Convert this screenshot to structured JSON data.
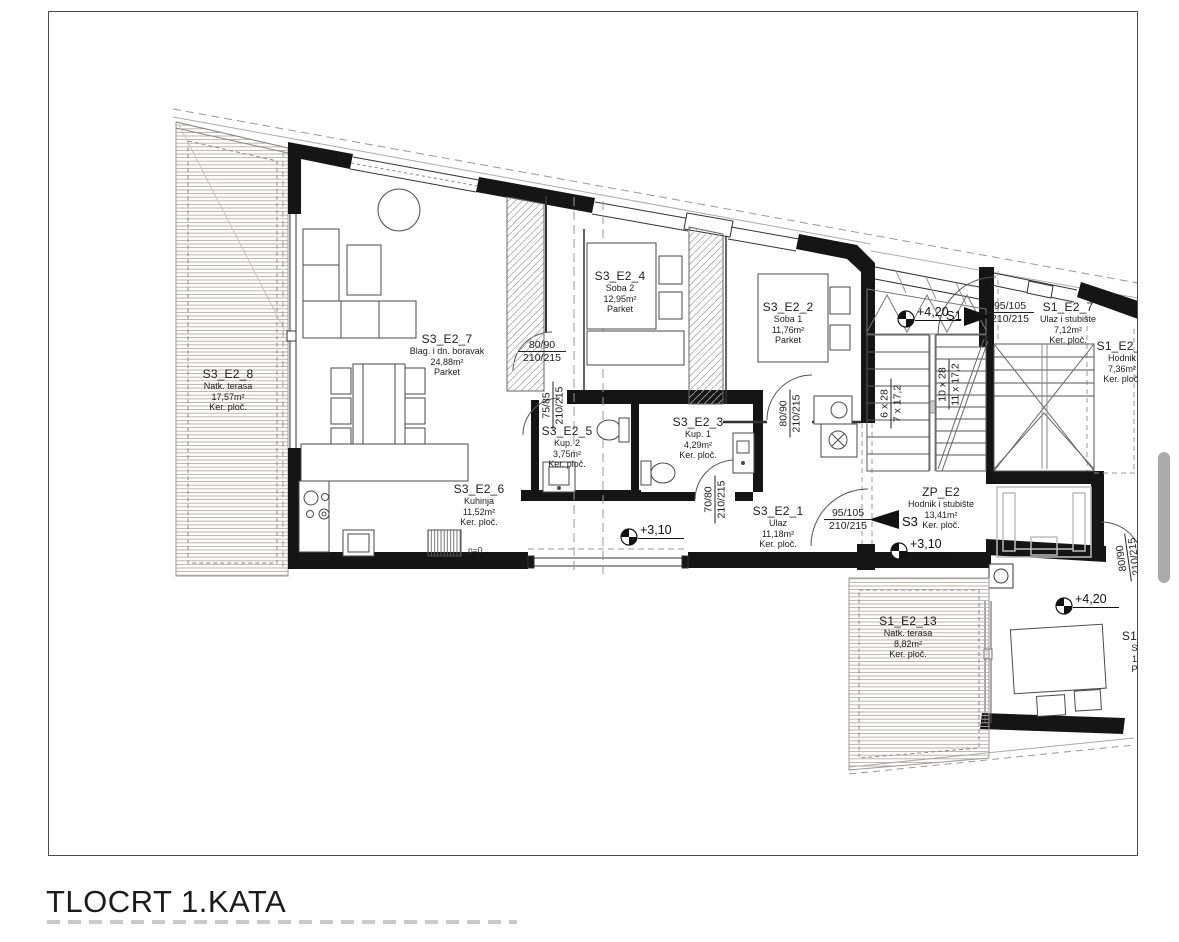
{
  "title": "TLOCRT 1.KATA",
  "plan": {
    "rooms": [
      {
        "id": "S3_E2_8",
        "type": "Natk. terasa",
        "area": "17,57m²",
        "floor": "Ker. ploč."
      },
      {
        "id": "S3_E2_7",
        "type": "Blag. i dn. boravak",
        "area": "24,88m²",
        "floor": "Parket"
      },
      {
        "id": "S3_E2_4",
        "type": "Soba 2",
        "area": "12,95m²",
        "floor": "Parket"
      },
      {
        "id": "S3_E2_2",
        "type": "Soba 1",
        "area": "11,76m²",
        "floor": "Parket"
      },
      {
        "id": "S3_E2_5",
        "type": "Kup. 2",
        "area": "3,75m²",
        "floor": "Ker. ploč."
      },
      {
        "id": "S3_E2_3",
        "type": "Kup. 1",
        "area": "4,29m²",
        "floor": "Ker. ploč."
      },
      {
        "id": "S3_E2_6",
        "type": "Kuhinja",
        "area": "11,52m²",
        "floor": "Ker. ploč."
      },
      {
        "id": "S3_E2_1",
        "type": "Ulaz",
        "area": "11,18m²",
        "floor": "Ker. ploč."
      },
      {
        "id": "ZP_E2",
        "type": "Hodnik i stubište",
        "area": "13,41m²",
        "floor": "Ker. ploč."
      },
      {
        "id": "S1_E2_7",
        "type": "Ulaz i stubište",
        "area": "7,12m²",
        "floor": "Ker. ploč."
      },
      {
        "id": "S1_E2_8",
        "type": "Hodnik",
        "area": "7,36m²",
        "floor": "Ker. ploč."
      },
      {
        "id": "S1_E2_13",
        "type": "Natk. terasa",
        "area": "8,82m²",
        "floor": "Ker. ploč."
      },
      {
        "id": "S1_E",
        "type": "So",
        "area": "15",
        "floor": "Pa"
      }
    ],
    "doors": [
      {
        "w": "80/90",
        "h": "210/215"
      },
      {
        "w": "75/85",
        "h": "210/215"
      },
      {
        "w": "80/90",
        "h": "210/215"
      },
      {
        "w": "70/80",
        "h": "210/215"
      },
      {
        "w": "95/105",
        "h": "210/215"
      },
      {
        "w": "95/105",
        "h": "210/215"
      },
      {
        "w": "80/90",
        "h": "210/215"
      }
    ],
    "stairs": [
      {
        "steps": "6 x 28",
        "rise": "7 x 17,2"
      },
      {
        "steps": "10 x 28",
        "rise": "11 x 17,2"
      }
    ],
    "levels": [
      "+4,20",
      "+3,10",
      "+3,10",
      "+4,20"
    ],
    "markers": {
      "s3": "S3",
      "s1": "S1"
    },
    "notes": {
      "kitchen_level": "p=0"
    }
  }
}
